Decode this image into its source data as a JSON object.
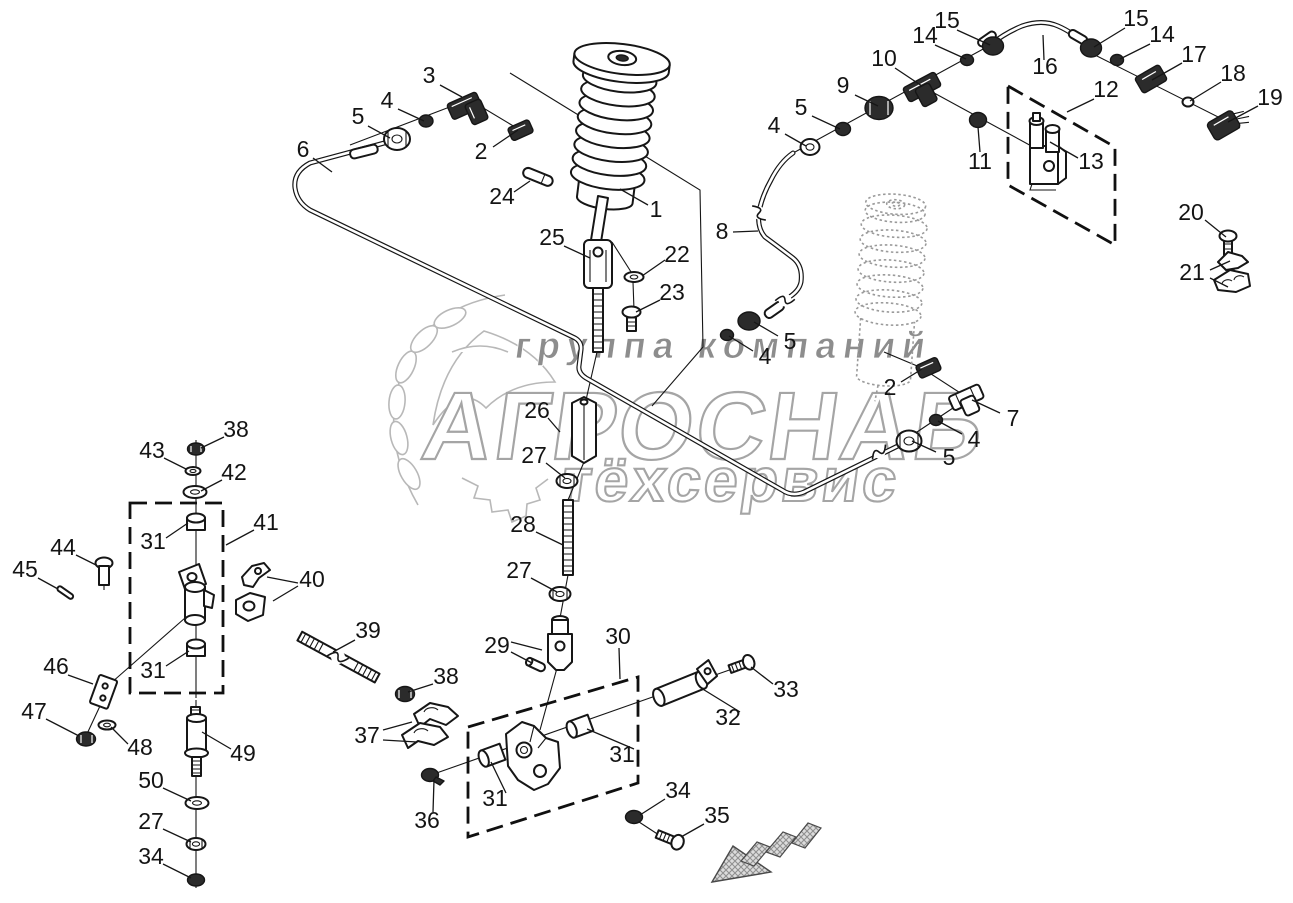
{
  "watermark": {
    "line1": "группа компаний",
    "line2": "АГРОСНАБ",
    "line3": "тёхсервис"
  },
  "diagram": {
    "background_color": "#ffffff",
    "line_color": "#161616",
    "watermark_gray": "#a5a5a5",
    "arrow_fill": "#d9d9d9",
    "callouts": [
      {
        "label": "3",
        "x": 429,
        "y": 77
      },
      {
        "label": "4",
        "x": 387,
        "y": 102
      },
      {
        "label": "5",
        "x": 358,
        "y": 118
      },
      {
        "label": "2",
        "x": 481,
        "y": 153
      },
      {
        "label": "6",
        "x": 303,
        "y": 151
      },
      {
        "label": "24",
        "x": 502,
        "y": 198
      },
      {
        "label": "1",
        "x": 656,
        "y": 211
      },
      {
        "label": "25",
        "x": 552,
        "y": 239
      },
      {
        "label": "22",
        "x": 677,
        "y": 256
      },
      {
        "label": "23",
        "x": 672,
        "y": 294
      },
      {
        "label": "8",
        "x": 722,
        "y": 233
      },
      {
        "label": "10",
        "x": 884,
        "y": 60
      },
      {
        "label": "9",
        "x": 843,
        "y": 87
      },
      {
        "label": "5",
        "x": 801,
        "y": 109
      },
      {
        "label": "4",
        "x": 774,
        "y": 127
      },
      {
        "label": "15",
        "x": 947,
        "y": 22
      },
      {
        "label": "14",
        "x": 925,
        "y": 37
      },
      {
        "label": "16",
        "x": 1045,
        "y": 68
      },
      {
        "label": "15",
        "x": 1136,
        "y": 20
      },
      {
        "label": "14",
        "x": 1162,
        "y": 36
      },
      {
        "label": "17",
        "x": 1194,
        "y": 56
      },
      {
        "label": "18",
        "x": 1233,
        "y": 75
      },
      {
        "label": "19",
        "x": 1270,
        "y": 99
      },
      {
        "label": "12",
        "x": 1106,
        "y": 91
      },
      {
        "label": "13",
        "x": 1091,
        "y": 163
      },
      {
        "label": "11",
        "x": 980,
        "y": 163
      },
      {
        "label": "20",
        "x": 1191,
        "y": 214
      },
      {
        "label": "21",
        "x": 1192,
        "y": 274
      },
      {
        "label": "2",
        "x": 890,
        "y": 389
      },
      {
        "label": "7",
        "x": 1013,
        "y": 420
      },
      {
        "label": "4",
        "x": 974,
        "y": 441
      },
      {
        "label": "5",
        "x": 949,
        "y": 459
      },
      {
        "label": "5",
        "x": 790,
        "y": 343
      },
      {
        "label": "4",
        "x": 765,
        "y": 358
      },
      {
        "label": "26",
        "x": 537,
        "y": 412
      },
      {
        "label": "27",
        "x": 534,
        "y": 457
      },
      {
        "label": "28",
        "x": 523,
        "y": 526
      },
      {
        "label": "27",
        "x": 519,
        "y": 572
      },
      {
        "label": "29",
        "x": 497,
        "y": 647
      },
      {
        "label": "30",
        "x": 618,
        "y": 638
      },
      {
        "label": "31",
        "x": 495,
        "y": 800
      },
      {
        "label": "31",
        "x": 622,
        "y": 756
      },
      {
        "label": "37",
        "x": 367,
        "y": 737
      },
      {
        "label": "38",
        "x": 446,
        "y": 678
      },
      {
        "label": "39",
        "x": 368,
        "y": 632
      },
      {
        "label": "36",
        "x": 427,
        "y": 822
      },
      {
        "label": "32",
        "x": 728,
        "y": 719
      },
      {
        "label": "33",
        "x": 786,
        "y": 691
      },
      {
        "label": "34",
        "x": 678,
        "y": 792
      },
      {
        "label": "35",
        "x": 717,
        "y": 817
      },
      {
        "label": "38",
        "x": 236,
        "y": 431
      },
      {
        "label": "43",
        "x": 152,
        "y": 452
      },
      {
        "label": "42",
        "x": 234,
        "y": 474
      },
      {
        "label": "41",
        "x": 266,
        "y": 524
      },
      {
        "label": "31",
        "x": 153,
        "y": 543
      },
      {
        "label": "44",
        "x": 63,
        "y": 549
      },
      {
        "label": "45",
        "x": 25,
        "y": 571
      },
      {
        "label": "40",
        "x": 312,
        "y": 581
      },
      {
        "label": "31",
        "x": 153,
        "y": 672
      },
      {
        "label": "46",
        "x": 56,
        "y": 668
      },
      {
        "label": "47",
        "x": 34,
        "y": 713
      },
      {
        "label": "48",
        "x": 140,
        "y": 749
      },
      {
        "label": "49",
        "x": 243,
        "y": 755
      },
      {
        "label": "50",
        "x": 151,
        "y": 782
      },
      {
        "label": "27",
        "x": 151,
        "y": 823
      },
      {
        "label": "34",
        "x": 151,
        "y": 858
      }
    ]
  }
}
